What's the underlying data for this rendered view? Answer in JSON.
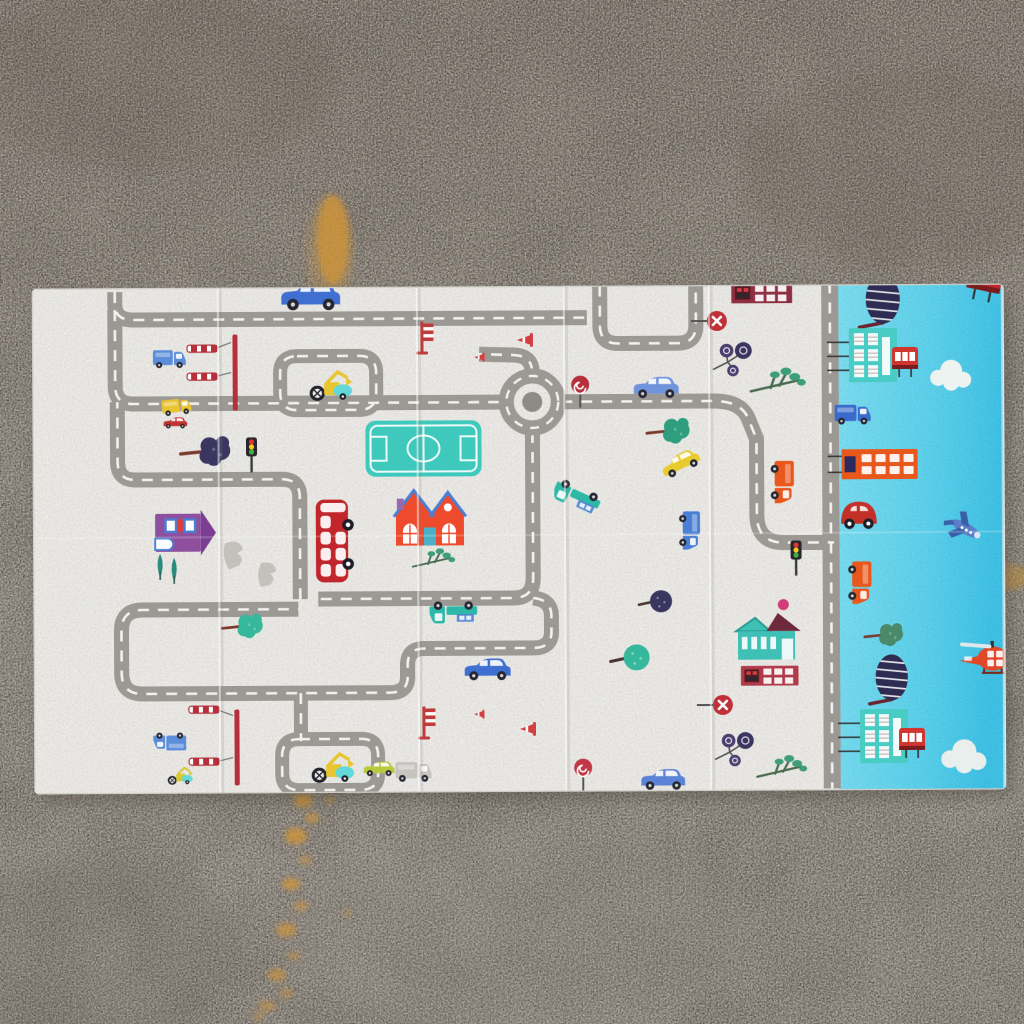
{
  "meta": {
    "alt": "Photograph of a foldable children's play mat on a concrete floor. The mat has a cream city road-map design with cartoon vehicles, houses and trees, and a light-blue side panel with buildings, cars, a plane and a helicopter. Orange paint stains on the concrete."
  },
  "palette": {
    "concrete_top": "#837a70",
    "concrete_mid": "#98928a",
    "concrete_bottom": "#928c84",
    "mat_white": "#ecebe7",
    "mat_blue_1": "#7edff2",
    "mat_blue_2": "#3fc3e8",
    "road": "#9c9893",
    "road_dash": "#f2f1ed",
    "stain_orange": "#d0953a",
    "accent_red": "#c0262c",
    "accent_teal": "#3fc8bc",
    "accent_yellow": "#e8c531",
    "accent_blue": "#3f6fd0"
  },
  "floor": {
    "stains": [
      {
        "x": 333,
        "y": 240,
        "rx": 16,
        "ry": 45,
        "o": 0.8
      },
      {
        "x": 330,
        "y": 252,
        "rx": 24,
        "ry": 58,
        "o": 0.25
      },
      {
        "x": 1010,
        "y": 577,
        "rx": 18,
        "ry": 13,
        "o": 0.5
      },
      {
        "x": 303,
        "y": 800,
        "rx": 10,
        "ry": 7,
        "o": 0.8
      },
      {
        "x": 330,
        "y": 800,
        "rx": 5,
        "ry": 4,
        "o": 0.6
      },
      {
        "x": 312,
        "y": 818,
        "rx": 7,
        "ry": 5,
        "o": 0.7
      },
      {
        "x": 296,
        "y": 836,
        "rx": 11,
        "ry": 8,
        "o": 0.8
      },
      {
        "x": 305,
        "y": 860,
        "rx": 6,
        "ry": 4,
        "o": 0.6
      },
      {
        "x": 291,
        "y": 884,
        "rx": 9,
        "ry": 6,
        "o": 0.75
      },
      {
        "x": 301,
        "y": 906,
        "rx": 7,
        "ry": 5,
        "o": 0.6
      },
      {
        "x": 286,
        "y": 930,
        "rx": 10,
        "ry": 7,
        "o": 0.7
      },
      {
        "x": 347,
        "y": 913,
        "rx": 4,
        "ry": 3,
        "o": 0.5
      },
      {
        "x": 294,
        "y": 956,
        "rx": 6,
        "ry": 4,
        "o": 0.55
      },
      {
        "x": 277,
        "y": 975,
        "rx": 9,
        "ry": 6,
        "o": 0.65
      },
      {
        "x": 286,
        "y": 993,
        "rx": 6,
        "ry": 5,
        "o": 0.5
      },
      {
        "x": 267,
        "y": 1006,
        "rx": 8,
        "ry": 5,
        "o": 0.6
      },
      {
        "x": 258,
        "y": 1017,
        "rx": 5,
        "ry": 4,
        "o": 0.5
      }
    ],
    "cracks": [
      {
        "d": "M320,410 C326,560 330,720 336,880"
      },
      {
        "d": "M660,520 C663,650 666,780 670,905"
      },
      {
        "d": "M185,90 C192,170 196,240 200,300"
      }
    ]
  },
  "mat": {
    "creases": [
      219,
      418,
      565,
      710
    ],
    "roundabout": {
      "cx": 533,
      "cy": 402,
      "r": 26,
      "inner": 10
    },
    "field": {
      "x": 366,
      "y": 420,
      "w": 116,
      "h": 56
    },
    "roads": [
      {
        "d": "M 116,290 L 116,302 Q 116,318 134,318 L 588,318",
        "w": 15
      },
      {
        "d": "M 601,286 L 601,326 Q 601,344 619,344 L 679,344 Q 697,344 697,326 L 697,286",
        "w": 15
      },
      {
        "d": "M 116,308 L 116,384 Q 116,402 134,402 L 504,402",
        "w": 15
      },
      {
        "d": "M 562,402 L 714,402 Q 742,402 749,420 L 757,440 L 757,516 Q 757,544 784,544 L 834,544",
        "w": 15
      },
      {
        "d": "M 533,372 Q 533,356 515,355 L 480,354",
        "w": 15
      },
      {
        "d": "M 533,432 L 533,578 Q 533,598 513,598 L 318,598",
        "w": 15
      },
      {
        "d": "M 300,598 L 300,496 Q 300,478 282,478 L 136,478 Q 118,478 118,460 L 118,400",
        "w": 15
      },
      {
        "d": "M 533,598 Q 551,600 551,616 L 551,632 Q 551,648 533,648 L 424,648 Q 407,648 407,664 L 407,676 Q 407,692 389,692 L 142,692 Q 121,692 121,671 L 121,629 Q 121,608 142,608 L 298,608",
        "w": 15
      },
      {
        "d": "M 298,355 L 360,355 Q 377,355 377,372 L 377,392 Q 377,409 360,409 L 298,409 Q 281,409 281,392 L 281,372 Q 281,355 298,355",
        "w": 14
      },
      {
        "d": "M 298,738 L 360,738 Q 377,738 377,755 L 377,772 Q 377,789 360,789 L 298,789 Q 281,789 281,772 L 281,755 Q 281,738 298,738",
        "w": 14
      },
      {
        "d": "M 300,692 L 300,740",
        "w": 14
      },
      {
        "d": "M 831,284 L 831,790",
        "w": 17
      }
    ],
    "wires": [
      {
        "d": "M216,347 L232,341"
      },
      {
        "d": "M216,375 L232,371"
      },
      {
        "d": "M216,708 L232,714"
      },
      {
        "d": "M216,760 L232,756"
      }
    ],
    "items": [
      {
        "t": "car",
        "x": 312,
        "y": 295,
        "r": 0,
        "s": 1.05,
        "c": "#3f6fd0"
      },
      {
        "t": "car",
        "x": 657,
        "y": 388,
        "r": 0,
        "s": 0.8,
        "c": "#6f94dc"
      },
      {
        "t": "car",
        "x": 487,
        "y": 669,
        "r": 0,
        "s": 0.82,
        "c": "#3f6fd0"
      },
      {
        "t": "car",
        "x": 662,
        "y": 780,
        "r": 0,
        "s": 0.78,
        "c": "#5b84d6"
      },
      {
        "t": "car",
        "x": 681,
        "y": 464,
        "r": -25,
        "s": 0.7,
        "c": "#e8cb2e"
      },
      {
        "t": "car",
        "x": 176,
        "y": 421,
        "r": 0,
        "s": 0.42,
        "c": "#c23333"
      },
      {
        "t": "car",
        "x": 378,
        "y": 768,
        "r": 0,
        "s": 0.55,
        "c": "#b7c93f"
      },
      {
        "t": "truckflat",
        "x": 577,
        "y": 497,
        "r": 205,
        "s": 0.85,
        "c": "#2fb8a8"
      },
      {
        "t": "truckflat",
        "x": 453,
        "y": 612,
        "r": 180,
        "s": 0.85,
        "c": "#2fb8a8"
      },
      {
        "t": "boxtruck",
        "x": 783,
        "y": 483,
        "r": 90,
        "s": 0.8,
        "c": "#e8571c"
      },
      {
        "t": "boxtruck",
        "x": 690,
        "y": 531,
        "r": 90,
        "s": 0.72,
        "c": "#4a7fd4"
      },
      {
        "t": "boxtruck",
        "x": 170,
        "y": 357,
        "r": 0,
        "s": 0.62,
        "c": "#5b8dd9"
      },
      {
        "t": "boxtruck",
        "x": 169,
        "y": 740,
        "r": 180,
        "s": 0.62,
        "c": "#5b8dd9"
      },
      {
        "t": "boxtruck",
        "x": 177,
        "y": 405,
        "r": -6,
        "s": 0.55,
        "c": "#e8c531"
      },
      {
        "t": "boxtruck",
        "x": 412,
        "y": 771,
        "r": 0,
        "s": 0.68,
        "c": "#c6c4bf"
      },
      {
        "t": "dbus",
        "x": 332,
        "y": 540,
        "r": -90,
        "s": 1.15,
        "c": "#c0262c"
      },
      {
        "t": "digger",
        "x": 330,
        "y": 388,
        "r": 0,
        "s": 0.85,
        "c": "#e8c531"
      },
      {
        "t": "digger",
        "x": 330,
        "y": 770,
        "r": 0,
        "s": 0.85,
        "c": "#e8c531"
      },
      {
        "t": "digger",
        "x": 178,
        "y": 776,
        "r": 0,
        "s": 0.5,
        "c": "#d8c832"
      },
      {
        "t": "redhouse",
        "x": 430,
        "y": 519,
        "r": 0,
        "s": 1.0,
        "c": "#ee4a2c"
      },
      {
        "t": "purplehouse",
        "x": 178,
        "y": 531,
        "r": 90,
        "s": 0.95,
        "c": "#8e4f9e"
      },
      {
        "t": "pinetrees",
        "x": 168,
        "y": 568,
        "r": 0,
        "s": 1.0,
        "c": "#2a8a80"
      },
      {
        "t": "tealhouse",
        "x": 766,
        "y": 640,
        "r": 0,
        "s": 0.95,
        "c": "#3fc0b6"
      },
      {
        "t": "brickbld",
        "x": 769,
        "y": 677,
        "r": 0,
        "s": 0.9,
        "c": "#b03a4a"
      },
      {
        "t": "brickbld",
        "x": 763,
        "y": 294,
        "r": 0,
        "s": 0.95,
        "c": "#8e2f42"
      },
      {
        "t": "blobtree",
        "x": 212,
        "y": 450,
        "r": 0,
        "s": 1.1,
        "c": "#3a3660"
      },
      {
        "t": "blobtree",
        "x": 674,
        "y": 432,
        "r": 0,
        "s": 0.95,
        "c": "#2e9e7e"
      },
      {
        "t": "blobtree",
        "x": 247,
        "y": 625,
        "r": 0,
        "s": 0.9,
        "c": "#35b89c"
      },
      {
        "t": "balltree",
        "x": 634,
        "y": 658,
        "r": 0,
        "s": 1.0,
        "c": "#35b89c"
      },
      {
        "t": "balltree",
        "x": 659,
        "y": 602,
        "r": 0,
        "s": 0.85,
        "c": "#3a3660"
      },
      {
        "t": "twigtree",
        "x": 778,
        "y": 386,
        "r": 0,
        "s": 1.1,
        "c": "#3f9e7a"
      },
      {
        "t": "twigtree",
        "x": 433,
        "y": 561,
        "r": 0,
        "s": 0.85,
        "c": "#3f9e7a"
      },
      {
        "t": "twigtree",
        "x": 780,
        "y": 772,
        "r": 0,
        "s": 1.0,
        "c": "#3f9e7a"
      },
      {
        "t": "lollipop3",
        "x": 737,
        "y": 358,
        "r": 0,
        "s": 1.05,
        "c": "#4a4070"
      },
      {
        "t": "lollipop3",
        "x": 737,
        "y": 748,
        "r": 0,
        "s": 1.05,
        "c": "#4a4070"
      },
      {
        "t": "trafficlight",
        "x": 252,
        "y": 452,
        "r": 0,
        "s": 1.0,
        "c": "#26262c"
      },
      {
        "t": "trafficlight",
        "x": 796,
        "y": 558,
        "r": 0,
        "s": 1.0,
        "c": "#26262c"
      },
      {
        "t": "noentry",
        "x": 718,
        "y": 322,
        "r": 0,
        "s": 1.0,
        "c": "#bf3038"
      },
      {
        "t": "noentry",
        "x": 722,
        "y": 706,
        "r": 0,
        "s": 1.0,
        "c": "#bf3038"
      },
      {
        "t": "swirlsign",
        "x": 581,
        "y": 385,
        "r": 0,
        "s": 1.0,
        "c": "#b5303a"
      },
      {
        "t": "swirlsign",
        "x": 582,
        "y": 768,
        "r": 0,
        "s": 1.0,
        "c": "#c23846"
      },
      {
        "t": "gate",
        "x": 203,
        "y": 347,
        "r": 0,
        "s": 1.0,
        "c": "#b5303a"
      },
      {
        "t": "gate",
        "x": 203,
        "y": 375,
        "r": 0,
        "s": 1.0,
        "c": "#b5303a"
      },
      {
        "t": "gate",
        "x": 203,
        "y": 708,
        "r": 0,
        "s": 1.0,
        "c": "#b5303a"
      },
      {
        "t": "gate",
        "x": 203,
        "y": 760,
        "r": 0,
        "s": 1.0,
        "c": "#b5303a"
      },
      {
        "t": "mast",
        "x": 236,
        "y": 369,
        "r": 0,
        "s": 1.0,
        "c": "#b5303a"
      },
      {
        "t": "mast",
        "x": 236,
        "y": 744,
        "r": 0,
        "s": 1.0,
        "c": "#b5303a"
      },
      {
        "t": "barrier",
        "x": 423,
        "y": 337,
        "r": 0,
        "s": 1.0,
        "c": "#c03a3a"
      },
      {
        "t": "barrier",
        "x": 423,
        "y": 722,
        "r": 0,
        "s": 1.0,
        "c": "#c03a3a"
      },
      {
        "t": "cone",
        "x": 527,
        "y": 340,
        "r": -90,
        "s": 1.0,
        "c": "#d34040"
      },
      {
        "t": "cone",
        "x": 481,
        "y": 357,
        "r": -90,
        "s": 0.65,
        "c": "#d34040"
      },
      {
        "t": "cone",
        "x": 528,
        "y": 729,
        "r": -90,
        "s": 1.0,
        "c": "#d34040"
      },
      {
        "t": "cone",
        "x": 479,
        "y": 714,
        "r": -90,
        "s": 0.65,
        "c": "#d34040"
      },
      {
        "t": "pinkdot",
        "x": 783,
        "y": 606,
        "r": 0,
        "s": 1.0,
        "c": "#d23c78"
      },
      {
        "t": "ghost",
        "x": 235,
        "y": 554,
        "r": 0,
        "s": 1.0,
        "c": "#c3c1bc"
      },
      {
        "t": "ghost",
        "x": 268,
        "y": 574,
        "r": 10,
        "s": 0.9,
        "c": "#c3c1bc"
      },
      {
        "t": "stripetree",
        "x": 884,
        "y": 303,
        "r": 0,
        "s": 0.9,
        "c": "#2e2c52"
      },
      {
        "t": "stripetree",
        "x": 891,
        "y": 681,
        "r": 0,
        "s": 0.85,
        "c": "#2e2c52"
      },
      {
        "t": "tealbuilding",
        "x": 874,
        "y": 357,
        "r": 0,
        "s": 1.0,
        "c": "#49ccc4"
      },
      {
        "t": "tealbuilding",
        "x": 883,
        "y": 738,
        "r": 0,
        "s": 1.0,
        "c": "#49ccc4"
      },
      {
        "t": "redbus-s",
        "x": 906,
        "y": 360,
        "r": 0,
        "s": 1.0,
        "c": "#d03530"
      },
      {
        "t": "redbus-s",
        "x": 911,
        "y": 741,
        "r": 0,
        "s": 1.0,
        "c": "#d03530"
      },
      {
        "t": "redbus-s",
        "x": 987,
        "y": 279,
        "r": 12,
        "s": 1.3,
        "c": "#c0262c"
      },
      {
        "t": "cloud",
        "x": 950,
        "y": 376,
        "r": 0,
        "s": 1.0,
        "c": "#edf3f1"
      },
      {
        "t": "cloud",
        "x": 961,
        "y": 757,
        "r": 0,
        "s": 1.1,
        "c": "#e9efed"
      },
      {
        "t": "boxtruck",
        "x": 853,
        "y": 416,
        "r": 0,
        "s": 0.68,
        "c": "#3a6bcc"
      },
      {
        "t": "orangebld",
        "x": 880,
        "y": 466,
        "r": 0,
        "s": 1.0,
        "c": "#e8581c"
      },
      {
        "t": "beetle",
        "x": 859,
        "y": 516,
        "r": 0,
        "s": 1.05,
        "c": "#c23028"
      },
      {
        "t": "boxtruck",
        "x": 860,
        "y": 584,
        "r": 90,
        "s": 0.8,
        "c": "#e8571c"
      },
      {
        "t": "blobtree",
        "x": 888,
        "y": 637,
        "r": 0,
        "s": 0.85,
        "c": "#4a8a6a"
      },
      {
        "t": "plane",
        "x": 966,
        "y": 531,
        "r": 210,
        "s": 1.0,
        "c": "#5a7fc8"
      },
      {
        "t": "heli",
        "x": 990,
        "y": 661,
        "r": 0,
        "s": 1.1,
        "c": "#e04828"
      }
    ]
  }
}
